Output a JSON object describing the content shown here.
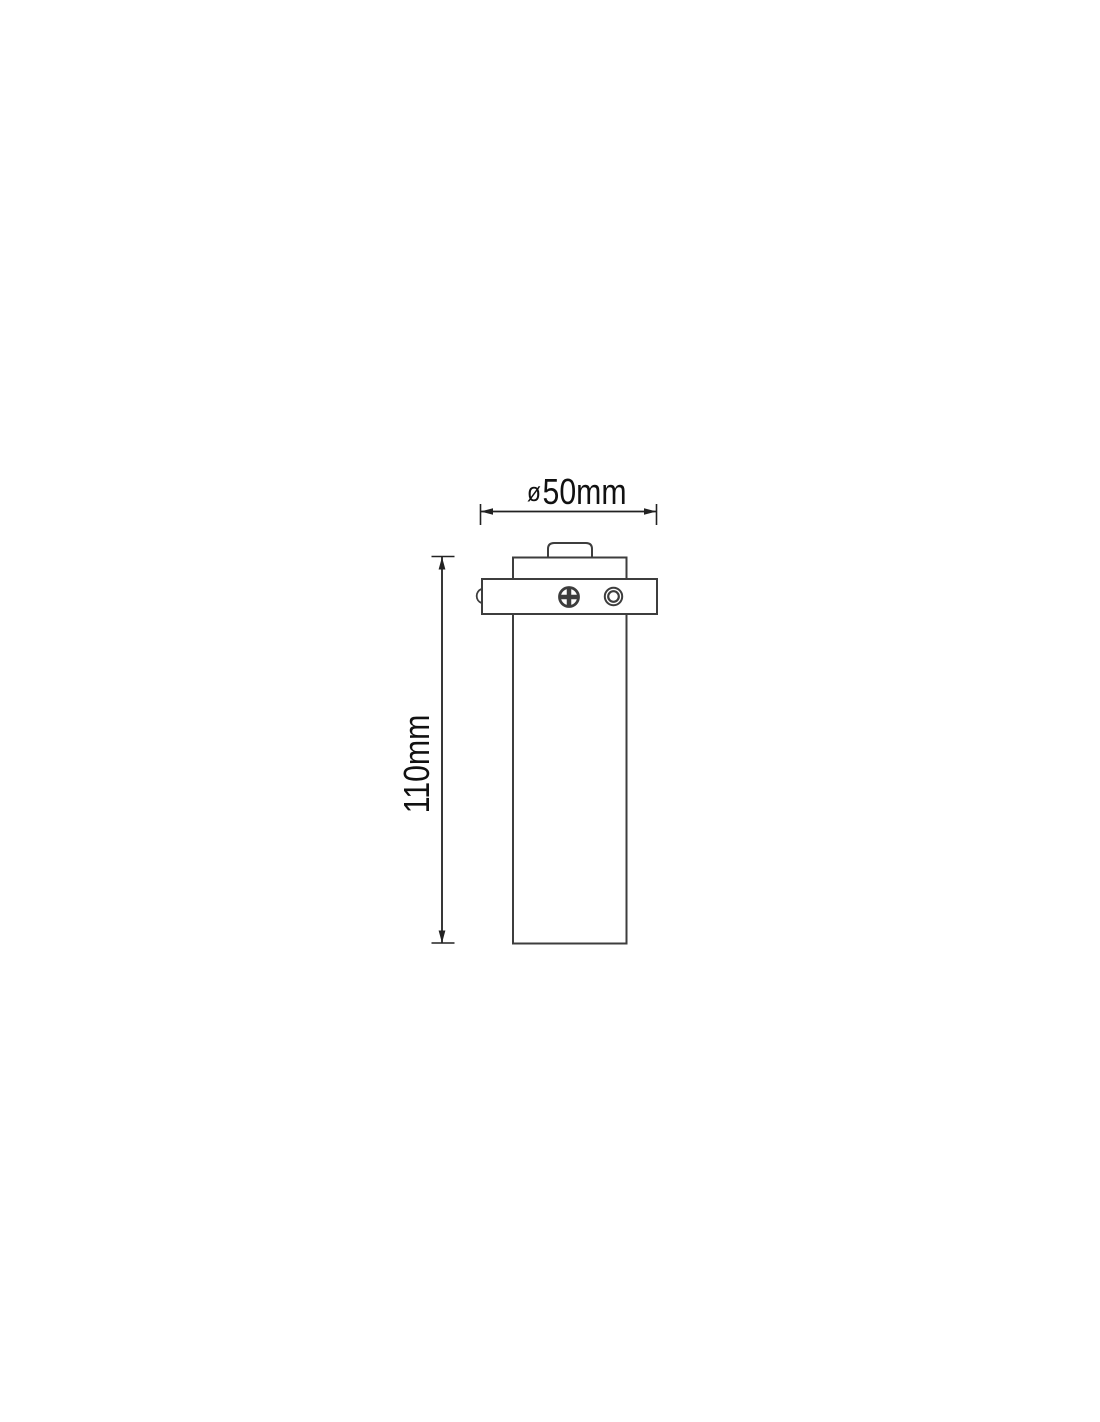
{
  "drawing": {
    "kind": "technical-dimension-drawing",
    "dimensions": {
      "diameter": {
        "symbol": "ø",
        "value": "50mm"
      },
      "height": {
        "value": "110mm"
      }
    },
    "colors": {
      "background": "#ffffff",
      "object_line": "#3d3d3d",
      "dimension_line": "#222222",
      "text": "#111111"
    }
  }
}
